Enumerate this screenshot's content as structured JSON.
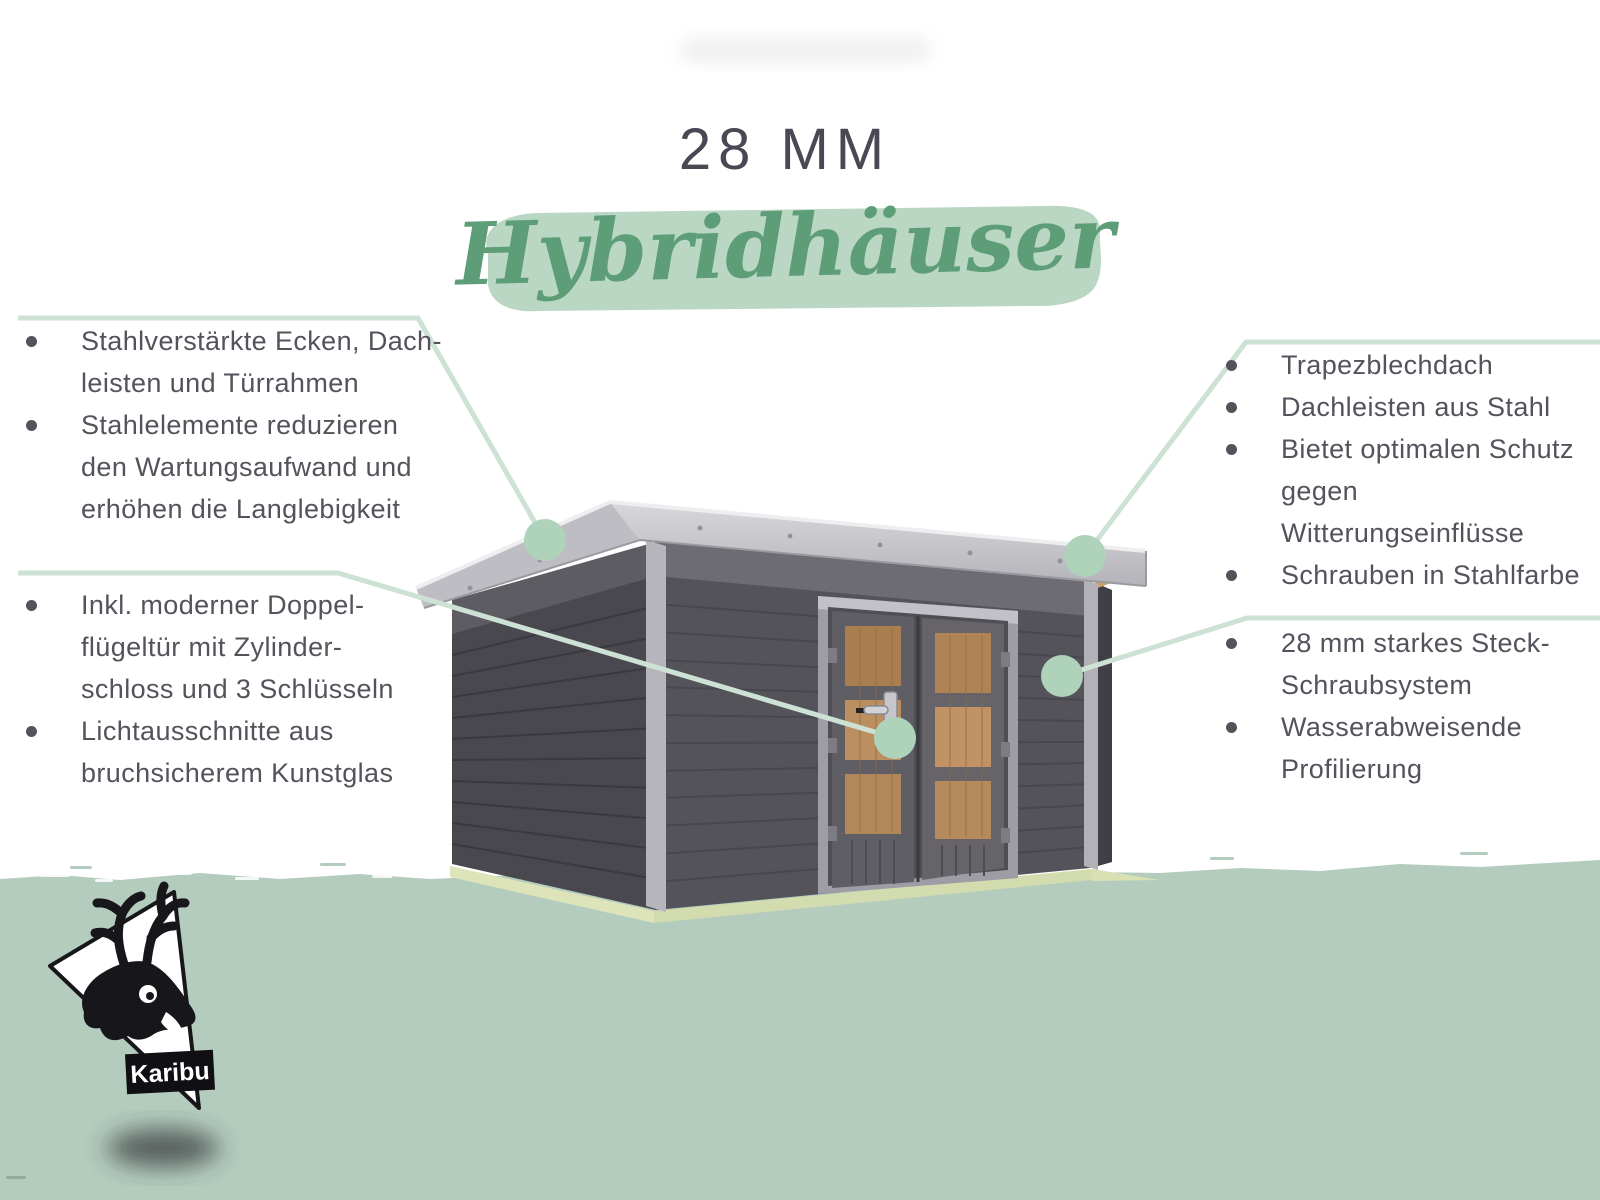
{
  "header": {
    "size_label": "28 MM",
    "product_name": "Hybridhäuser"
  },
  "features_left_top": {
    "items": [
      {
        "lines": [
          "Stahlverstärkte Ecken, Dach-",
          "leisten und Türrahmen"
        ]
      },
      {
        "lines": [
          "Stahlelemente reduzieren",
          "den Wartungsaufwand und",
          "erhöhen die Langlebigkeit"
        ]
      }
    ]
  },
  "features_left_bottom": {
    "items": [
      {
        "lines": [
          "Inkl. moderner Doppel-",
          "flügeltür mit Zylinder-",
          "schloss und 3 Schlüsseln"
        ]
      },
      {
        "lines": [
          "Lichtausschnitte aus",
          "bruchsicherem Kunstglas"
        ]
      }
    ]
  },
  "features_right_top": {
    "items": [
      {
        "lines": [
          "Trapezblechdach"
        ]
      },
      {
        "lines": [
          "Dachleisten aus Stahl"
        ]
      },
      {
        "lines": [
          "Bietet optimalen Schutz",
          "gegen Witterungseinflüsse"
        ]
      },
      {
        "lines": [
          "Schrauben in Stahlfarbe"
        ]
      }
    ]
  },
  "features_right_bottom": {
    "items": [
      {
        "lines": [
          "28 mm starkes Steck-",
          "Schraubsystem"
        ]
      },
      {
        "lines": [
          "Wasserabweisende",
          "Profilierung"
        ]
      }
    ]
  },
  "logo": {
    "brand": "Karibu"
  },
  "colors": {
    "accent_green": "#5d9d78",
    "brush_green": "#b5d4c0",
    "connector_line_green": "#cde2d4",
    "marker_dot_green": "#aed2ba",
    "ground_green": "#b3ccbe",
    "text_dark": "#56525c",
    "title_dark": "#4c4754",
    "wall_gray": "#55535a",
    "roof_gray": "#c5c4ca",
    "door_glass_amber": "#b5895c"
  }
}
